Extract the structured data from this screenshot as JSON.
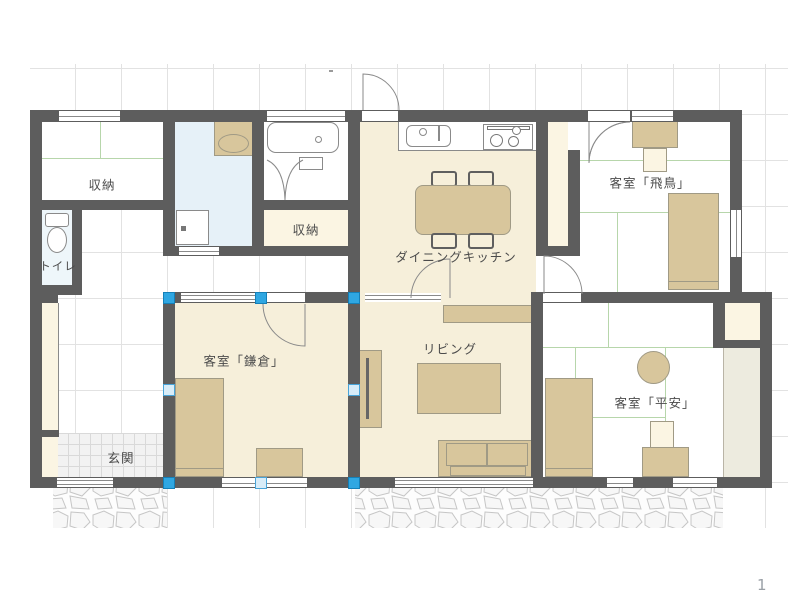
{
  "rooms": {
    "storage_nw": {
      "label": "収納"
    },
    "toilet": {
      "label": "トイレ"
    },
    "storage_mid": {
      "label": "収納"
    },
    "dining_kitchen": {
      "label": "ダイニングキッチン"
    },
    "guest_asuka": {
      "label": "客室「飛鳥」"
    },
    "guest_kamakura": {
      "label": "客室「鎌倉」"
    },
    "living": {
      "label": "リビング"
    },
    "guest_heian": {
      "label": "客室「平安」"
    },
    "entrance": {
      "label": "玄関"
    }
  },
  "page": {
    "number": "1"
  },
  "colors": {
    "wall": "#5d5d5d",
    "floor_beige": "#f6efda",
    "closet_cream": "#fbf5e3",
    "washroom_blue": "#e6f1f8",
    "toilet_blue": "#eef6fa",
    "furniture_tan": "#d8c69c",
    "tatami_green": "#b7d6ab",
    "selection_handle": "#2fa7e2",
    "grid": "#e2e2e2"
  }
}
